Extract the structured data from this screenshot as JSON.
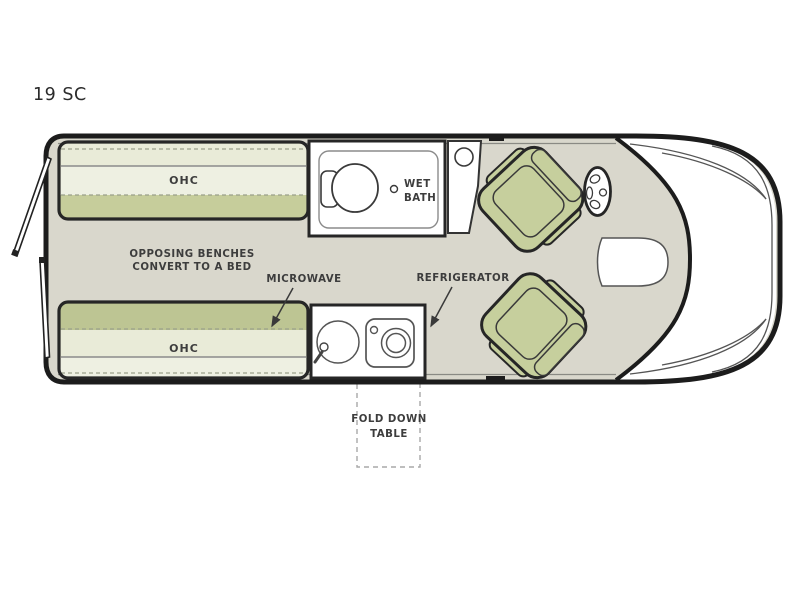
{
  "page": {
    "kind": "rv-floorplan"
  },
  "labels": {
    "model": "19 SC",
    "ohc_top": "OHC",
    "ohc_bottom": "OHC",
    "benches_note_1": "OPPOSING BENCHES",
    "benches_note_2": "CONVERT TO A BED",
    "microwave": "MICROWAVE",
    "refrigerator": "REFRIGERATOR",
    "wet_bath_1": "WET",
    "wet_bath_2": "BATH",
    "fold_table_1": "FOLD DOWN",
    "fold_table_2": "TABLE"
  },
  "colors": {
    "floor": "#d9d7cc",
    "outline": "#1c1c1c",
    "bench_pale": "#e9ebd8",
    "bench_light": "#eef0e2",
    "bench_olive": "#c6cd9b",
    "bench_olive_dark": "#bdc593",
    "seat_green": "#c6cf9d",
    "label_text": "#3d3d3d"
  }
}
